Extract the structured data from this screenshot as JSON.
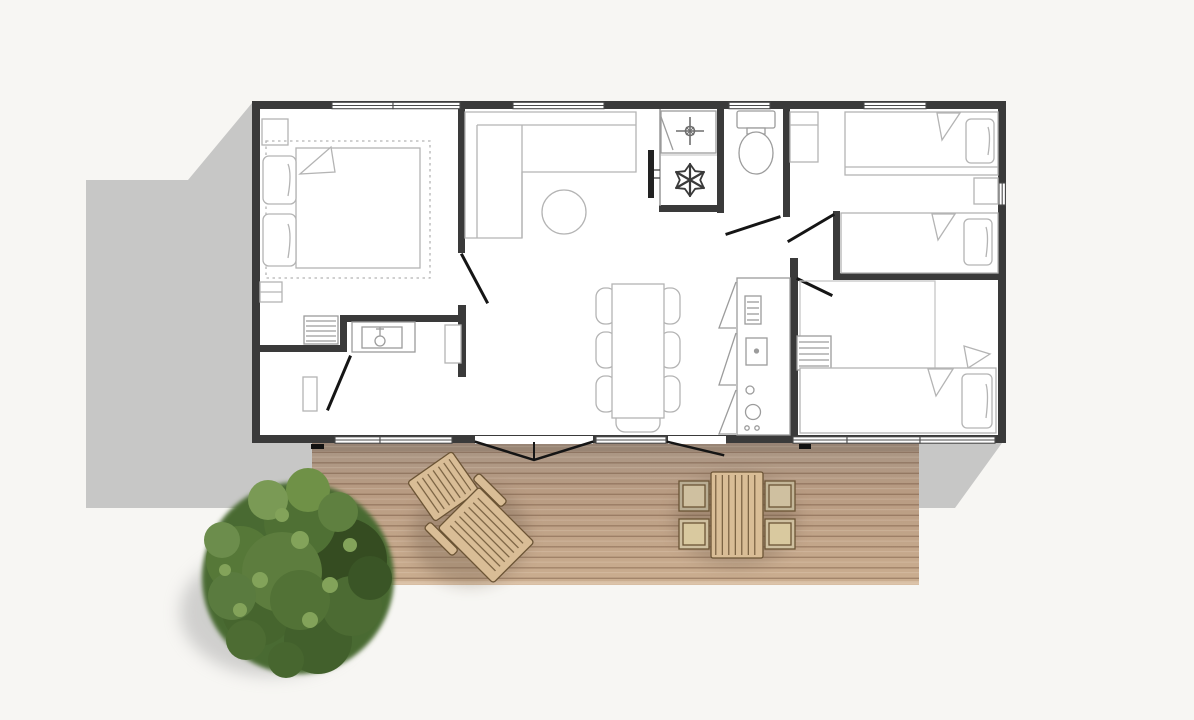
{
  "scene": {
    "description": "top-down architectural floor plan of a holiday mobile home with wooden terrace and tree",
    "background_color": "#f7f6f3",
    "shadow_color": "#c7c7c6"
  },
  "floor_plan": {
    "wall_color": "#3a3a3a",
    "floor_color": "#ffffff",
    "furniture_line_color": "#b4b4b4",
    "fixture_line_color": "#8f8f8f",
    "door_leaf_color": "#151515",
    "window_frame_color": "#4a4a4a",
    "rooms": [
      {
        "name": "master-bedroom",
        "furniture": [
          "double-bed",
          "two-pillows",
          "nightstand",
          "wardrobe",
          "dresser",
          "rug-outline"
        ]
      },
      {
        "name": "ensuite-bathroom",
        "furniture": [
          "washbasin-counter",
          "shelf",
          "radiator"
        ]
      },
      {
        "name": "living-room",
        "furniture": [
          "corner-sofa",
          "round-table",
          "wall-tv"
        ]
      },
      {
        "name": "shower-utility-closet",
        "furniture": [
          "shower-tray",
          "air-conditioner"
        ]
      },
      {
        "name": "wc",
        "furniture": [
          "toilet"
        ]
      },
      {
        "name": "kitchen",
        "furniture": [
          "counter",
          "sink",
          "stove",
          "open-cabinet-doors"
        ]
      },
      {
        "name": "dining-area",
        "furniture": [
          "table",
          "seven-chairs"
        ]
      },
      {
        "name": "twin-bedroom",
        "furniture": [
          "twin-bed",
          "twin-bed",
          "nightstand",
          "wardrobe"
        ]
      },
      {
        "name": "third-bedroom",
        "furniture": [
          "single-bed",
          "second-mattress",
          "ladder-drawers"
        ]
      }
    ],
    "icons": [
      "snowflake-icon",
      "shower-drain-icon"
    ]
  },
  "terrace": {
    "deck_top_color": "#a79585",
    "deck_mid_color": "#b89b82",
    "deck_bottom_color": "#cbae90",
    "plank_line_color": "rgba(96,66,44,0.38)",
    "furniture": {
      "wood_color": "#d9bd96",
      "chair_seat_color": "#cfc0a0",
      "outline_color": "#6b5435",
      "items": [
        "sun-lounger",
        "outdoor-table",
        "outdoor-chair",
        "outdoor-chair",
        "outdoor-chair",
        "outdoor-chair"
      ]
    }
  },
  "tree": {
    "greens": [
      "#33491f",
      "#4a6a31",
      "#5d7d3e",
      "#6f9147",
      "#83a35a"
    ],
    "shadow_color": "#a9a9a9"
  }
}
